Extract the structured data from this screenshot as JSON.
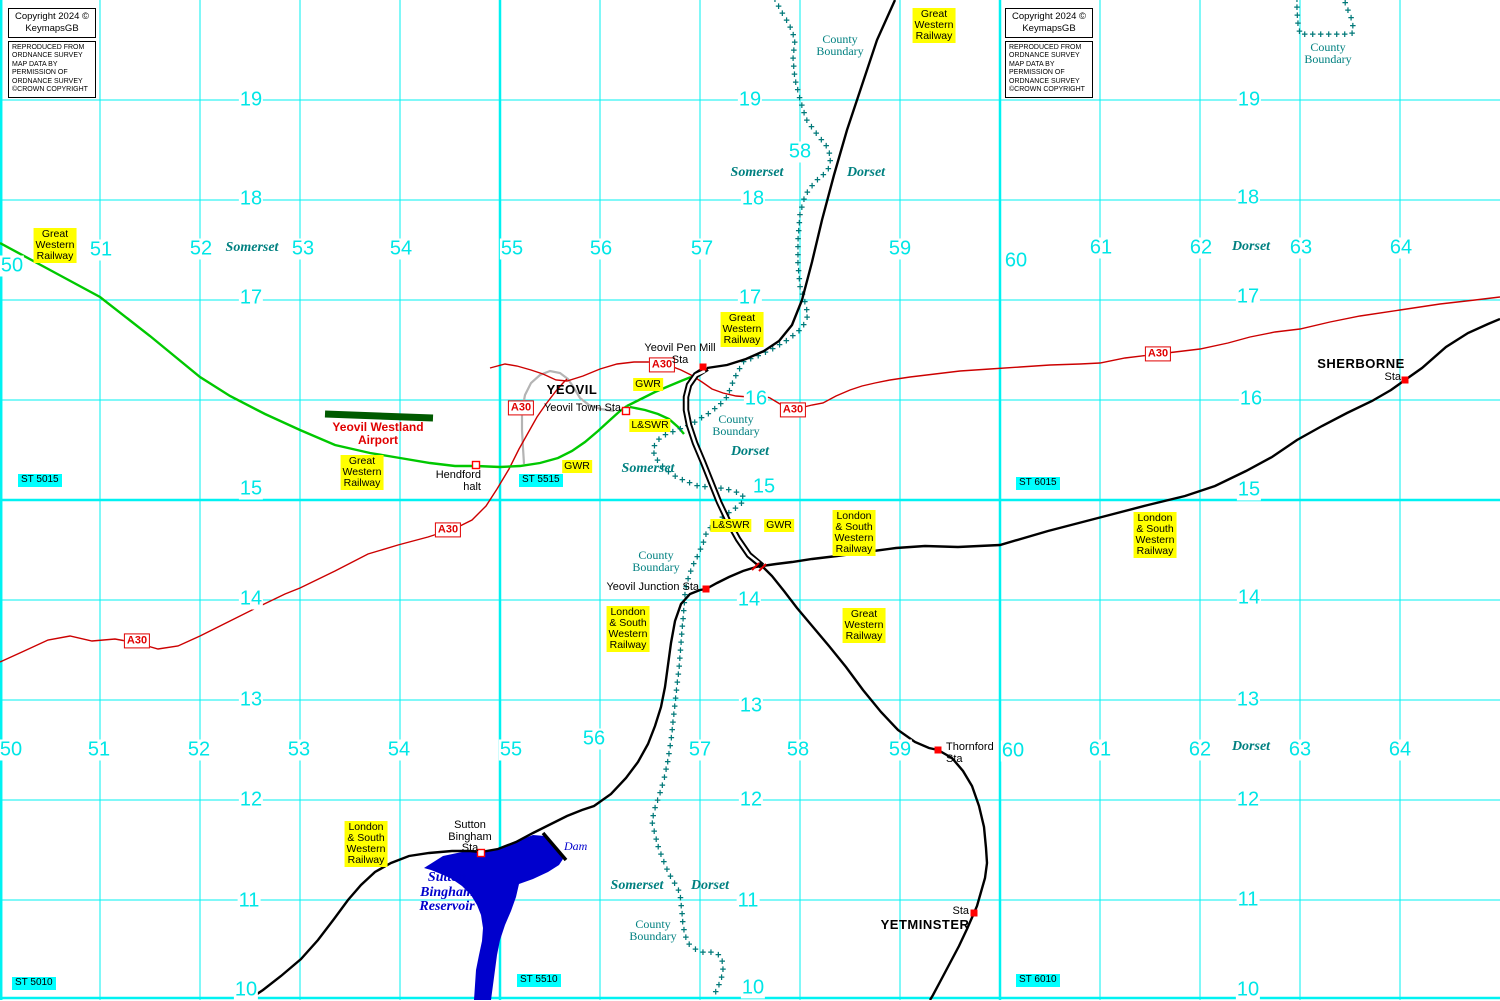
{
  "map": {
    "colors": {
      "grid_line": "#00F2F2",
      "grid_number": "#00E6E6",
      "boundary": "#007878",
      "county_text": "#008080",
      "railway": "#000000",
      "gwr_line": "#00C800",
      "runway": "#005A00",
      "road": "#CC0000",
      "road_sign": "#E00000",
      "water": "#0000CD",
      "water_text": "#0000CC",
      "label_bg": "#FFFF00",
      "gridref_bg": "#00FFFF",
      "dismantled": "#B4B4B4",
      "station_marker": "#FF0000"
    },
    "copyright": {
      "lines": [
        "Copyright 2024 ©",
        "KeymapsGB"
      ]
    },
    "os_notice": {
      "lines": [
        "REPRODUCED FROM",
        "ORDNANCE SURVEY",
        "MAP DATA BY",
        "PERMISSION OF",
        "ORDNANCE SURVEY",
        "©CROWN COPYRIGHT"
      ]
    },
    "copyright_blocks": [
      {
        "x": 8,
        "y": 8
      },
      {
        "x": 1005,
        "y": 8
      }
    ],
    "grid": {
      "minor_x": [
        100,
        200,
        300,
        400,
        600,
        700,
        800,
        900,
        1100,
        1200,
        1300,
        1400
      ],
      "major_x": [
        0,
        500,
        1000
      ],
      "minor_y": [
        100,
        200,
        300,
        400,
        600,
        700,
        800,
        900
      ],
      "major_y": [
        500,
        998
      ],
      "numbers": [
        {
          "t": "50",
          "x": 12,
          "y": 266
        },
        {
          "t": "51",
          "x": 101,
          "y": 250
        },
        {
          "t": "52",
          "x": 201,
          "y": 249
        },
        {
          "t": "53",
          "x": 303,
          "y": 249
        },
        {
          "t": "54",
          "x": 401,
          "y": 249
        },
        {
          "t": "55",
          "x": 512,
          "y": 249
        },
        {
          "t": "56",
          "x": 601,
          "y": 249
        },
        {
          "t": "57",
          "x": 702,
          "y": 249
        },
        {
          "t": "58",
          "x": 800,
          "y": 152
        },
        {
          "t": "59",
          "x": 900,
          "y": 249
        },
        {
          "t": "60",
          "x": 1016,
          "y": 261
        },
        {
          "t": "61",
          "x": 1101,
          "y": 248
        },
        {
          "t": "62",
          "x": 1201,
          "y": 248
        },
        {
          "t": "63",
          "x": 1301,
          "y": 248
        },
        {
          "t": "64",
          "x": 1401,
          "y": 248
        },
        {
          "t": "50",
          "x": 11,
          "y": 750
        },
        {
          "t": "51",
          "x": 99,
          "y": 750
        },
        {
          "t": "52",
          "x": 199,
          "y": 750
        },
        {
          "t": "53",
          "x": 299,
          "y": 750
        },
        {
          "t": "54",
          "x": 399,
          "y": 750
        },
        {
          "t": "55",
          "x": 511,
          "y": 750
        },
        {
          "t": "56",
          "x": 594,
          "y": 739
        },
        {
          "t": "57",
          "x": 700,
          "y": 750
        },
        {
          "t": "58",
          "x": 798,
          "y": 750
        },
        {
          "t": "59",
          "x": 900,
          "y": 750
        },
        {
          "t": "60",
          "x": 1013,
          "y": 751
        },
        {
          "t": "61",
          "x": 1100,
          "y": 750
        },
        {
          "t": "62",
          "x": 1200,
          "y": 750
        },
        {
          "t": "63",
          "x": 1300,
          "y": 750
        },
        {
          "t": "64",
          "x": 1400,
          "y": 750
        },
        {
          "t": "19",
          "x": 251,
          "y": 100
        },
        {
          "t": "18",
          "x": 251,
          "y": 199
        },
        {
          "t": "17",
          "x": 251,
          "y": 298
        },
        {
          "t": "15",
          "x": 251,
          "y": 489
        },
        {
          "t": "14",
          "x": 251,
          "y": 599
        },
        {
          "t": "13",
          "x": 251,
          "y": 700
        },
        {
          "t": "12",
          "x": 251,
          "y": 800
        },
        {
          "t": "11",
          "x": 249,
          "y": 901
        },
        {
          "t": "10",
          "x": 246,
          "y": 990
        },
        {
          "t": "19",
          "x": 750,
          "y": 100
        },
        {
          "t": "18",
          "x": 753,
          "y": 199
        },
        {
          "t": "17",
          "x": 750,
          "y": 298
        },
        {
          "t": "16",
          "x": 756,
          "y": 399
        },
        {
          "t": "15",
          "x": 764,
          "y": 487
        },
        {
          "t": "14",
          "x": 749,
          "y": 600
        },
        {
          "t": "13",
          "x": 751,
          "y": 706
        },
        {
          "t": "12",
          "x": 751,
          "y": 800
        },
        {
          "t": "11",
          "x": 748,
          "y": 901
        },
        {
          "t": "10",
          "x": 753,
          "y": 988
        },
        {
          "t": "19",
          "x": 1249,
          "y": 100
        },
        {
          "t": "18",
          "x": 1248,
          "y": 198
        },
        {
          "t": "17",
          "x": 1248,
          "y": 297
        },
        {
          "t": "16",
          "x": 1251,
          "y": 399
        },
        {
          "t": "15",
          "x": 1249,
          "y": 490
        },
        {
          "t": "14",
          "x": 1249,
          "y": 598
        },
        {
          "t": "13",
          "x": 1248,
          "y": 700
        },
        {
          "t": "12",
          "x": 1248,
          "y": 800
        },
        {
          "t": "11",
          "x": 1248,
          "y": 900
        },
        {
          "t": "10",
          "x": 1248,
          "y": 990
        }
      ]
    },
    "grid_refs": [
      {
        "label": "ST 5015",
        "x": 18,
        "y": 474
      },
      {
        "label": "ST 5515",
        "x": 519,
        "y": 474
      },
      {
        "label": "ST 6015",
        "x": 1016,
        "y": 477
      },
      {
        "label": "ST 5010",
        "x": 12,
        "y": 977
      },
      {
        "label": "ST 5510",
        "x": 517,
        "y": 974
      },
      {
        "label": "ST 6010",
        "x": 1016,
        "y": 974
      }
    ],
    "counties": [
      {
        "label": "Somerset",
        "x": 252,
        "y": 241
      },
      {
        "label": "Dorset",
        "x": 1251,
        "y": 240
      },
      {
        "label": "Somerset",
        "x": 757,
        "y": 166
      },
      {
        "label": "Dorset",
        "x": 866,
        "y": 166
      },
      {
        "label": "Somerset",
        "x": 648,
        "y": 462
      },
      {
        "label": "Dorset",
        "x": 750,
        "y": 445
      },
      {
        "label": "Somerset",
        "x": 637,
        "y": 879
      },
      {
        "label": "Dorset",
        "x": 710,
        "y": 879
      },
      {
        "label": "Dorset",
        "x": 1251,
        "y": 740
      }
    ],
    "boundary_labels": {
      "lines": [
        "County",
        "Boundary"
      ],
      "positions": [
        {
          "x": 840,
          "y": 33
        },
        {
          "x": 1328,
          "y": 41
        },
        {
          "x": 736,
          "y": 413
        },
        {
          "x": 656,
          "y": 549
        },
        {
          "x": 653,
          "y": 918
        }
      ]
    },
    "railway_labels": [
      {
        "lines": [
          "Great",
          "Western",
          "Railway"
        ],
        "x": 934,
        "y": 8
      },
      {
        "lines": [
          "Great",
          "Western",
          "Railway"
        ],
        "x": 55,
        "y": 228
      },
      {
        "lines": [
          "Great",
          "Western",
          "Railway"
        ],
        "x": 742,
        "y": 312
      },
      {
        "lines": [
          "Great",
          "Western",
          "Railway"
        ],
        "x": 362,
        "y": 455
      },
      {
        "lines": [
          "Great",
          "Western",
          "Railway"
        ],
        "x": 864,
        "y": 608
      },
      {
        "lines": [
          "GWR"
        ],
        "x": 577,
        "y": 460
      },
      {
        "lines": [
          "GWR"
        ],
        "x": 648,
        "y": 378
      },
      {
        "lines": [
          "GWR"
        ],
        "x": 779,
        "y": 519
      },
      {
        "lines": [
          "L&SWR"
        ],
        "x": 650,
        "y": 419
      },
      {
        "lines": [
          "L&SWR"
        ],
        "x": 731,
        "y": 519
      },
      {
        "lines": [
          "London",
          "& South",
          "Western",
          "Railway"
        ],
        "x": 854,
        "y": 510
      },
      {
        "lines": [
          "London",
          "& South",
          "Western",
          "Railway"
        ],
        "x": 628,
        "y": 606
      },
      {
        "lines": [
          "London",
          "& South",
          "Western",
          "Railway"
        ],
        "x": 1155,
        "y": 512
      },
      {
        "lines": [
          "London",
          "& South",
          "Western",
          "Railway"
        ],
        "x": 366,
        "y": 821
      }
    ],
    "road_signs": [
      {
        "label": "A30",
        "x": 137,
        "y": 641
      },
      {
        "label": "A30",
        "x": 448,
        "y": 530
      },
      {
        "label": "A30",
        "x": 521,
        "y": 408
      },
      {
        "label": "A30",
        "x": 662,
        "y": 365
      },
      {
        "label": "A30",
        "x": 793,
        "y": 410
      },
      {
        "label": "A30",
        "x": 1158,
        "y": 354
      }
    ],
    "towns": [
      {
        "label": "YEOVIL",
        "x": 572,
        "y": 383
      },
      {
        "label": "SHERBORNE",
        "x": 1361,
        "y": 357
      },
      {
        "label": "YETMINSTER",
        "x": 925,
        "y": 918
      }
    ],
    "stations": [
      {
        "lines": [
          "Yeovil Pen Mill",
          "Sta"
        ],
        "x": 680,
        "y": 343,
        "align": "center",
        "marker": {
          "x": 703,
          "y": 367,
          "style": "filled"
        }
      },
      {
        "lines": [
          "Yeovil Town Sta"
        ],
        "x": 621,
        "y": 403,
        "align": "right",
        "marker": {
          "x": 626,
          "y": 411,
          "style": "open"
        }
      },
      {
        "lines": [
          "Hendford",
          "halt"
        ],
        "x": 481,
        "y": 470,
        "align": "right",
        "marker": {
          "x": 476,
          "y": 465,
          "style": "open"
        }
      },
      {
        "lines": [
          "Yeovil Junction Sta"
        ],
        "x": 699,
        "y": 582,
        "align": "right",
        "marker": {
          "x": 706,
          "y": 589,
          "style": "filled"
        }
      },
      {
        "lines": [
          "Thornford",
          "Sta"
        ],
        "x": 946,
        "y": 742,
        "align": "left",
        "marker": {
          "x": 938,
          "y": 750,
          "style": "filled"
        }
      },
      {
        "lines": [
          "Sta"
        ],
        "x": 1401,
        "y": 372,
        "align": "right",
        "marker": {
          "x": 1405,
          "y": 380,
          "style": "filled"
        }
      },
      {
        "lines": [
          "Sutton",
          "Bingham",
          "Sta"
        ],
        "x": 470,
        "y": 820,
        "align": "center",
        "marker": {
          "x": 481,
          "y": 853,
          "style": "open"
        }
      },
      {
        "lines": [
          "Sta"
        ],
        "x": 969,
        "y": 906,
        "align": "right",
        "marker": {
          "x": 974,
          "y": 913,
          "style": "filled"
        }
      }
    ],
    "airport": {
      "lines": [
        "Yeovil Westland",
        "Airport"
      ],
      "x": 378,
      "y": 421
    },
    "reservoir_label": {
      "lines": [
        "Sutton",
        "Bingham",
        "Reservoir"
      ],
      "x": 447,
      "y": 871
    },
    "dam_label": {
      "label": "Dam",
      "x": 564,
      "y": 840
    }
  }
}
